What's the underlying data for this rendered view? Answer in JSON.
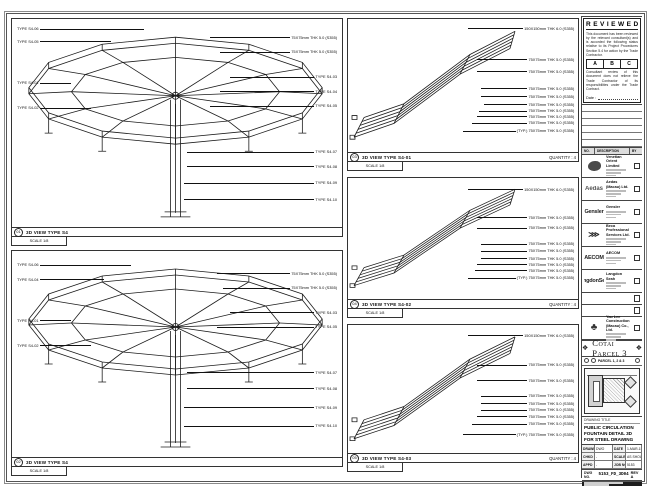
{
  "sheet": {
    "note_top": "DO NOT SCALE DRAWING - VERIFY ALL DIMENSIONS ON SITE"
  },
  "stamp": {
    "title": "REVIEWED",
    "para1": "This document has been reviewed by the relevant consultant(s) and is accorded the following status relative to its Project Procedures Section 5.4 for action by the Trade Contractor.",
    "grades": [
      "A",
      "B",
      "C"
    ],
    "para2": "Consultant review of this document does not relieve the Trade Contractor of its responsibilities under the Trade Contract.",
    "date_label": "Date :"
  },
  "revisions": {
    "headers": [
      "NO.",
      "DESCRIPTION",
      "BY"
    ],
    "empty_rows": 6
  },
  "consultants": [
    {
      "logo": "venetian",
      "logo_text": "",
      "name": "Venetian Orient Limited"
    },
    {
      "logo": "aedas",
      "logo_text": "Aedas",
      "name": "Aedas (Macau) Ltd."
    },
    {
      "logo": "gensler",
      "logo_text": "Gensler",
      "name": "Gensler"
    },
    {
      "logo": "beca",
      "logo_text": "⋙",
      "name": "Beca Professional Services Ltd."
    },
    {
      "logo": "aecom",
      "logo_text": "AECOM",
      "name": "AECOM"
    },
    {
      "logo": "langdon",
      "logo_text": "LangdonSeah",
      "name": "Langdon Seah"
    },
    {
      "logo": "blank",
      "logo_text": "",
      "name": ""
    },
    {
      "logo": "blank",
      "logo_text": "",
      "name": ""
    },
    {
      "logo": "yaulee",
      "logo_text": "♣",
      "name": "Yau Lee Construction (Macau) Co., Ltd."
    }
  ],
  "project": {
    "title": "Cotai Parcel 3",
    "keyplan_label": "PARCEL 1, 2 & 3"
  },
  "titleblock": {
    "drawing_title_label": "DRAWING TITLE",
    "drawing_title": "PUBLIC CIRCULATION FOUNTAIN DETAIL 3D FOR STEEL DRAWING",
    "fields": [
      {
        "l": "DRAWN",
        "v": "DWO"
      },
      {
        "l": "DATE",
        "v": "1-MAR-15"
      },
      {
        "l": "CHKD",
        "v": "-"
      },
      {
        "l": "SCALE",
        "v": "AS SHOWN"
      },
      {
        "l": "APPD",
        "v": "-"
      },
      {
        "l": "JOB NO.",
        "v": "5153"
      }
    ],
    "dwg_no_label": "DWG NO.",
    "dwg_no": "5153_FD_3D04",
    "rev": "REV A"
  },
  "panels": [
    {
      "num": "01",
      "title": "3D VIEW TYPE S4",
      "quantity": "",
      "scale": "SCALE 1/8",
      "callouts": [
        {
          "side": "left",
          "top": 4,
          "to": 40,
          "text": "TYPE S4-06"
        },
        {
          "side": "left",
          "top": 10,
          "to": 30,
          "text": "TYPE S4-05"
        },
        {
          "side": "left",
          "top": 30,
          "to": 18,
          "text": "TYPE S4-01"
        },
        {
          "side": "left",
          "top": 42,
          "to": 24,
          "text": "TYPE S4-02"
        },
        {
          "side": "right",
          "top": 8,
          "from": 60,
          "text": "75X75mm THK 5.0 (S355)"
        },
        {
          "side": "right",
          "top": 15,
          "from": 63,
          "text": "75X75mm THK 5.0 (S355)"
        },
        {
          "side": "right",
          "top": 27,
          "from": 66,
          "text": "TYPE S4-03"
        },
        {
          "side": "right",
          "top": 34,
          "from": 63,
          "text": "TYPE S4-04"
        },
        {
          "side": "right",
          "top": 41,
          "from": 60,
          "text": "TYPE S4-05"
        },
        {
          "side": "right",
          "top": 63,
          "from": 53,
          "text": "TYPE S4-07"
        },
        {
          "side": "right",
          "top": 70,
          "from": 53,
          "text": "TYPE S4-08"
        },
        {
          "side": "right",
          "top": 78,
          "from": 52,
          "text": "TYPE S4-09"
        },
        {
          "side": "right",
          "top": 86,
          "from": 52,
          "text": "TYPE S4-10"
        }
      ]
    },
    {
      "num": "02",
      "title": "3D VIEW TYPE S4",
      "quantity": "",
      "scale": "SCALE 1/8",
      "callouts": [
        {
          "side": "left",
          "top": 6,
          "to": 36,
          "text": "TYPE S4-06"
        },
        {
          "side": "left",
          "top": 13,
          "to": 28,
          "text": "TYPE S4-04"
        },
        {
          "side": "left",
          "top": 33,
          "to": 18,
          "text": "TYPE S4-01"
        },
        {
          "side": "left",
          "top": 45,
          "to": 24,
          "text": "TYPE S4-02"
        },
        {
          "side": "right",
          "top": 10,
          "from": 62,
          "text": "75X75mm THK 5.0 (S355)"
        },
        {
          "side": "right",
          "top": 17,
          "from": 64,
          "text": "75X75mm THK 5.0 (S355)"
        },
        {
          "side": "right",
          "top": 29,
          "from": 66,
          "text": "TYPE S4-03"
        },
        {
          "side": "right",
          "top": 36,
          "from": 62,
          "text": "TYPE S4-05"
        },
        {
          "side": "right",
          "top": 58,
          "from": 53,
          "text": "TYPE S4-07"
        },
        {
          "side": "right",
          "top": 66,
          "from": 53,
          "text": "TYPE S4-08"
        },
        {
          "side": "right",
          "top": 75,
          "from": 52,
          "text": "TYPE S4-09"
        },
        {
          "side": "right",
          "top": 84,
          "from": 52,
          "text": "TYPE S4-10"
        }
      ]
    },
    {
      "num": "03",
      "title": "3D VIEW TYPE S4-01",
      "quantity": "QUANTITY : 4",
      "scale": "SCALE 1/8",
      "callouts": [
        {
          "side": "right",
          "top": 6,
          "from": 52,
          "text": "150X150mm THK 6.0 (S355)"
        },
        {
          "side": "right",
          "top": 29,
          "from": 56,
          "text": "75X75mm THK 5.0 (S355)"
        },
        {
          "side": "right",
          "top": 38,
          "from": 56,
          "text": "75X75mm THK 5.0 (S355)"
        },
        {
          "side": "right",
          "top": 51,
          "from": 58,
          "text": "75X75mm THK 5.0 (S355)"
        },
        {
          "side": "right",
          "top": 57,
          "from": 58,
          "text": "75X75mm THK 5.0 (S355)"
        },
        {
          "side": "right",
          "top": 63,
          "from": 59,
          "text": "75X75mm THK 5.0 (S355)"
        },
        {
          "side": "right",
          "top": 68,
          "from": 57,
          "text": "75X75mm THK 5.0 (S355)"
        },
        {
          "side": "right",
          "top": 72,
          "from": 56,
          "text": "75X75mm THK 5.0 (S355)"
        },
        {
          "side": "right",
          "top": 77,
          "from": 54,
          "text": "75X75mm THK 5.0 (S355)"
        },
        {
          "side": "right",
          "top": 83,
          "from": 50,
          "text": "(TYP.) 75X75mm THK 5.0 (S355)"
        }
      ]
    },
    {
      "num": "04",
      "title": "3D VIEW TYPE S4-02",
      "quantity": "QUANTITY : 4",
      "scale": "SCALE 1/8",
      "callouts": [
        {
          "side": "right",
          "top": 8,
          "from": 52,
          "text": "150X150mm THK 6.0 (S355)"
        },
        {
          "side": "right",
          "top": 31,
          "from": 56,
          "text": "75X75mm THK 5.0 (S355)"
        },
        {
          "side": "right",
          "top": 40,
          "from": 56,
          "text": "75X75mm THK 5.0 (S355)"
        },
        {
          "side": "right",
          "top": 53,
          "from": 58,
          "text": "75X75mm THK 5.0 (S355)"
        },
        {
          "side": "right",
          "top": 59,
          "from": 58,
          "text": "75X75mm THK 5.0 (S355)"
        },
        {
          "side": "right",
          "top": 65,
          "from": 58,
          "text": "75X75mm THK 5.0 (S355)"
        },
        {
          "side": "right",
          "top": 70,
          "from": 56,
          "text": "75X75mm THK 5.0 (S355)"
        },
        {
          "side": "right",
          "top": 75,
          "from": 55,
          "text": "75X75mm THK 5.0 (S355)"
        },
        {
          "side": "right",
          "top": 81,
          "from": 52,
          "text": "(TYP.) 75X75mm THK 5.0 (S355)"
        }
      ]
    },
    {
      "num": "05",
      "title": "3D VIEW TYPE S4-03",
      "quantity": "QUANTITY : 4",
      "scale": "SCALE 1/8",
      "callouts": [
        {
          "side": "right",
          "top": 7,
          "from": 52,
          "text": "150X150mm THK 6.0 (S355)"
        },
        {
          "side": "right",
          "top": 30,
          "from": 56,
          "text": "75X75mm THK 5.0 (S355)"
        },
        {
          "side": "right",
          "top": 42,
          "from": 56,
          "text": "75X75mm THK 5.0 (S355)"
        },
        {
          "side": "right",
          "top": 54,
          "from": 58,
          "text": "75X75mm THK 5.0 (S355)"
        },
        {
          "side": "right",
          "top": 60,
          "from": 58,
          "text": "75X75mm THK 5.0 (S355)"
        },
        {
          "side": "right",
          "top": 65,
          "from": 58,
          "text": "75X75mm THK 5.0 (S355)"
        },
        {
          "side": "right",
          "top": 70,
          "from": 56,
          "text": "75X75mm THK 5.0 (S355)"
        },
        {
          "side": "right",
          "top": 76,
          "from": 54,
          "text": "75X75mm THK 5.0 (S355)"
        },
        {
          "side": "right",
          "top": 84,
          "from": 50,
          "text": "(TYP.) 75X75mm THK 5.0 (S355)"
        }
      ]
    }
  ]
}
